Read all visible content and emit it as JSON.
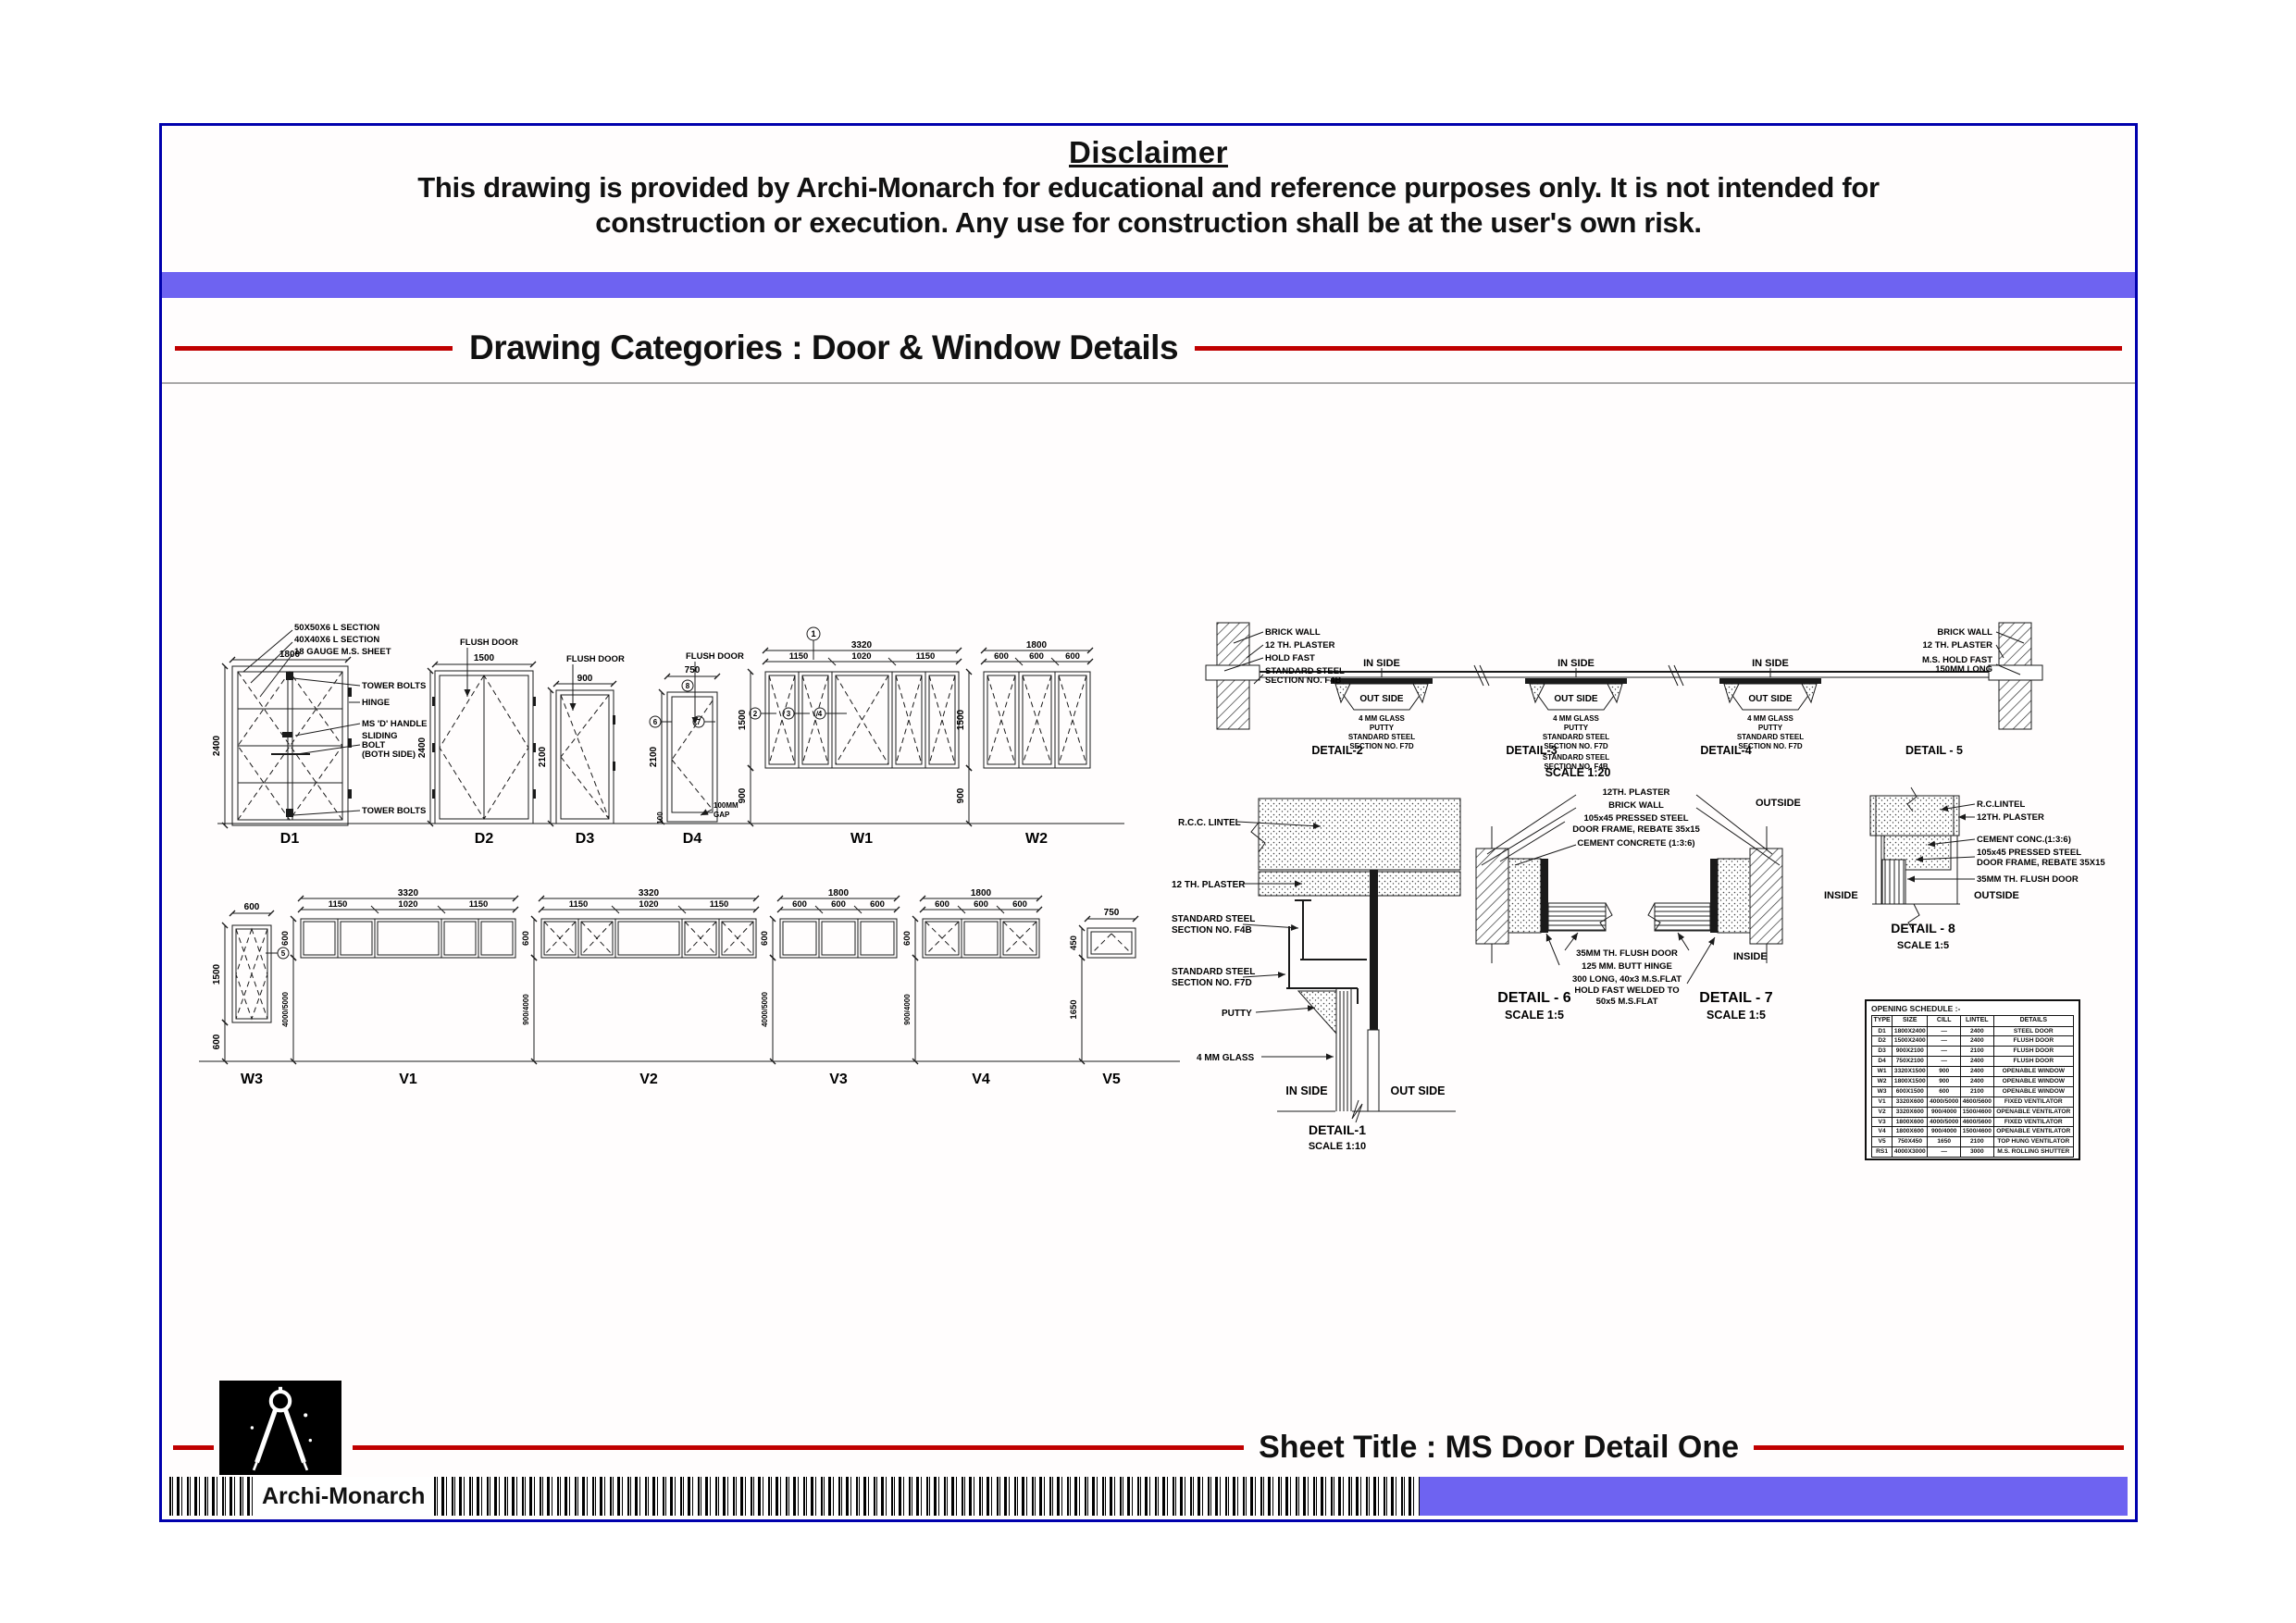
{
  "page": {
    "background": "#ffffff",
    "sheet_border": "#0000ad",
    "accent_bar": "#6e63f1",
    "rule_red": "#c00000",
    "ink": "#111111"
  },
  "disclaimer": {
    "title": "Disclaimer",
    "line1": "This drawing is provided by Archi-Monarch for educational and reference purposes only. It is not intended for",
    "line2": "construction or execution. Any use for construction shall be at the user's own risk."
  },
  "header": {
    "category": "Drawing Categories : Door & Window Details"
  },
  "footer": {
    "sheet_title": "Sheet Title : MS Door Detail One",
    "brand": "Archi-Monarch",
    "logo": "compass-icon"
  },
  "elev": {
    "d1": {
      "name": "D1",
      "w": "1800",
      "h": "2400",
      "n0": "50X50X6 L SECTION",
      "n1": "40X40X6 L SECTION",
      "n2": "18 GAUGE M.S. SHEET",
      "r0": "TOWER BOLTS",
      "r1": "HINGE",
      "r2": "MS 'D' HANDLE",
      "r3": "SLIDING",
      "r4": "BOLT",
      "r5": "(BOTH SIDE)",
      "r6": "TOWER BOLTS"
    },
    "d2": {
      "name": "D2",
      "w": "1500",
      "h": "2400",
      "note": "FLUSH DOOR"
    },
    "d3": {
      "name": "D3",
      "w": "900",
      "h": "2100",
      "note": "FLUSH DOOR"
    },
    "d4": {
      "name": "D4",
      "w": "750",
      "h": "2100",
      "note": "FLUSH DOOR",
      "g1": "100MM",
      "g2": "GAP",
      "b": "100",
      "m1": "8",
      "m2": "6",
      "m3": "7"
    },
    "w1": {
      "name": "W1",
      "w": "3320",
      "s0": "1150",
      "s1": "1020",
      "s2": "1150",
      "h": "1500",
      "sill": "900",
      "m1": "1",
      "m2": "2",
      "m3": "3",
      "m4": "4"
    },
    "w2": {
      "name": "W2",
      "w": "1800",
      "seg": "600",
      "h": "1500",
      "sill": "900"
    },
    "w3": {
      "name": "W3",
      "w": "600",
      "h": "1500",
      "sill": "600",
      "m": "5"
    },
    "v1": {
      "name": "V1",
      "w": "3320",
      "s0": "1150",
      "s1": "1020",
      "s2": "1150",
      "h": "600",
      "sill": "4000/5000"
    },
    "v2": {
      "name": "V2",
      "w": "3320",
      "s0": "1150",
      "s1": "1020",
      "s2": "1150",
      "h": "600",
      "sill": "900/4000"
    },
    "v3": {
      "name": "V3",
      "w": "1800",
      "seg": "600",
      "h": "600",
      "sill": "4000/5000"
    },
    "v4": {
      "name": "V4",
      "w": "1800",
      "seg": "600",
      "h": "600",
      "sill": "900/4000"
    },
    "v5": {
      "name": "V5",
      "w": "750",
      "h": "450",
      "sill": "1650"
    }
  },
  "plan": {
    "l0": "BRICK WALL",
    "l1": "12 TH. PLASTER",
    "l2": "HOLD FAST",
    "l3": "STANDARD STEEL",
    "l4": "SECTION NO. F4B",
    "r0": "BRICK WALL",
    "r1": "12 TH. PLASTER",
    "r2": "M.S. HOLD FAST",
    "r3": "150MM LONG",
    "inside": "IN SIDE",
    "outside": "OUT SIDE",
    "c0": "4 MM GLASS",
    "c1": "PUTTY",
    "c2": "STANDARD STEEL",
    "c3": "SECTION NO. F7D",
    "c4": "STANDARD STEEL",
    "c5": "SECTION NO. F4B",
    "cap0": "DETAIL-2",
    "cap1": "DETAIL-3",
    "cap2": "DETAIL-4",
    "cap3": "DETAIL - 5",
    "scale": "SCALE 1:20"
  },
  "det1": {
    "lintel": "R.C.C. LINTEL",
    "plaster": "12 TH. PLASTER",
    "f4b_a": "STANDARD STEEL",
    "f4b_b": "SECTION NO. F4B",
    "f7d_a": "STANDARD STEEL",
    "f7d_b": "SECTION NO. F7D",
    "putty": "PUTTY",
    "glass": "4 MM GLASS",
    "inside": "IN SIDE",
    "outside": "OUT SIDE",
    "cap": "DETAIL-1",
    "scale": "SCALE 1:10"
  },
  "det67": {
    "t0": "12TH. PLASTER",
    "t1": "BRICK WALL",
    "t2": "105x45 PRESSED STEEL",
    "t3": "DOOR FRAME, REBATE 35x15",
    "t4": "CEMENT CONCRETE (1:3:6)",
    "outside": "OUTSIDE",
    "b0": "35MM TH. FLUSH DOOR",
    "b1": "125 MM. BUTT HINGE",
    "b2": "300 LONG, 40x3 M.S.FLAT",
    "b3": "HOLD FAST WELDED TO",
    "b4": "50x5 M.S.FLAT",
    "inside": "INSIDE",
    "cap6": "DETAIL - 6",
    "cap7": "DETAIL - 7",
    "scale": "SCALE 1:5"
  },
  "det8": {
    "n0": "R.C.LINTEL",
    "n1": "12TH. PLASTER",
    "n2": "CEMENT CONC.(1:3:6)",
    "n3": "105x45 PRESSED STEEL",
    "n4": "DOOR FRAME, REBATE 35X15",
    "n5": "35MM TH. FLUSH DOOR",
    "inside": "INSIDE",
    "outside": "OUTSIDE",
    "cap": "DETAIL - 8",
    "scale": "SCALE 1:5"
  },
  "schedule": {
    "title": "OPENING SCHEDULE :-",
    "headers": [
      "TYPE",
      "SIZE",
      "CILL",
      "LINTEL",
      "DETAILS"
    ],
    "rows": [
      [
        "D1",
        "1800X2400",
        "—",
        "2400",
        "STEEL DOOR"
      ],
      [
        "D2",
        "1500X2400",
        "—",
        "2400",
        "FLUSH DOOR"
      ],
      [
        "D3",
        "900X2100",
        "—",
        "2100",
        "FLUSH DOOR"
      ],
      [
        "D4",
        "750X2100",
        "—",
        "2400",
        "FLUSH DOOR"
      ],
      [
        "W1",
        "3320X1500",
        "900",
        "2400",
        "OPENABLE WINDOW"
      ],
      [
        "W2",
        "1800X1500",
        "900",
        "2400",
        "OPENABLE WINDOW"
      ],
      [
        "W3",
        "600X1500",
        "600",
        "2100",
        "OPENABLE WINDOW"
      ],
      [
        "V1",
        "3320X600",
        "4000/5000",
        "4600/5600",
        "FIXED VENTILATOR"
      ],
      [
        "V2",
        "3320X600",
        "900/4000",
        "1500/4600",
        "OPENABLE VENTILATOR"
      ],
      [
        "V3",
        "1800X600",
        "4000/5000",
        "4600/5600",
        "FIXED VENTILATOR"
      ],
      [
        "V4",
        "1800X600",
        "900/4000",
        "1500/4600",
        "OPENABLE VENTILATOR"
      ],
      [
        "V5",
        "750X450",
        "1650",
        "2100",
        "TOP HUNG VENTILATOR"
      ],
      [
        "RS1",
        "4000X3000",
        "—",
        "3000",
        "M.S. ROLLING SHUTTER"
      ]
    ]
  }
}
